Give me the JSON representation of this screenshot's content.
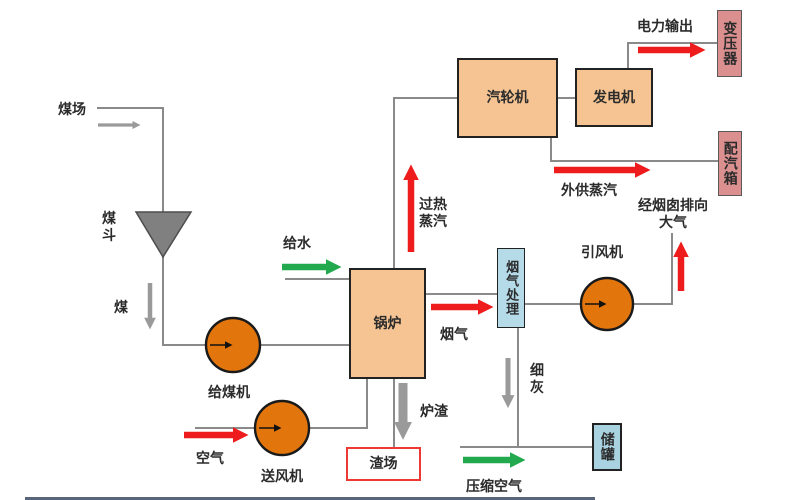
{
  "colors": {
    "bg": "#ffffff",
    "box-peach": "#f6c493",
    "box-pink": "#db8f8f",
    "box-blue": "#b5dbe8",
    "box-blue2": "#a9d2e0",
    "box-border-dark": "#222222",
    "slag-border": "#ed3833",
    "circle-orange": "#e2760d",
    "line-gray": "#8a8a8a",
    "arrow-gray": "#9a9a9a",
    "arrow-red": "#ee1c1c",
    "arrow-green": "#22a94e",
    "funnel-gray": "#808080",
    "text": "#2b2b2b",
    "bottom-strip": "#3c4a63"
  },
  "nodes": {
    "coal_yard": {
      "label": "煤场"
    },
    "coal_hopper": {
      "label": "煤\n斗"
    },
    "coal_feeder": {
      "label": "给煤机"
    },
    "fd_fan": {
      "label": "送风机"
    },
    "boiler": {
      "label": "锅炉"
    },
    "turbine": {
      "label": "汽轮机"
    },
    "generator": {
      "label": "发电机"
    },
    "transformer": {
      "label": "变压器"
    },
    "steam_dist_box": {
      "label": "配汽箱"
    },
    "flue_gas_treatment": {
      "label": "烟气处理"
    },
    "id_fan": {
      "label": "引风机"
    },
    "slag_yard": {
      "label": "渣场"
    },
    "storage_tank": {
      "label": "储罐"
    }
  },
  "flows": {
    "coal": {
      "label": "煤"
    },
    "feed_water": {
      "label": "给水"
    },
    "air": {
      "label": "空气"
    },
    "superheated_steam": {
      "label": "过热\n蒸汽"
    },
    "flue_gas": {
      "label": "烟气"
    },
    "slag": {
      "label": "炉渣"
    },
    "fine_ash": {
      "label": "细\n灰"
    },
    "compressed_air": {
      "label": "压缩空气"
    },
    "power_output": {
      "label": "电力输出"
    },
    "external_steam": {
      "label": "外供蒸汽"
    },
    "to_atmosphere": {
      "label": "经烟囱排向\n大气"
    }
  }
}
